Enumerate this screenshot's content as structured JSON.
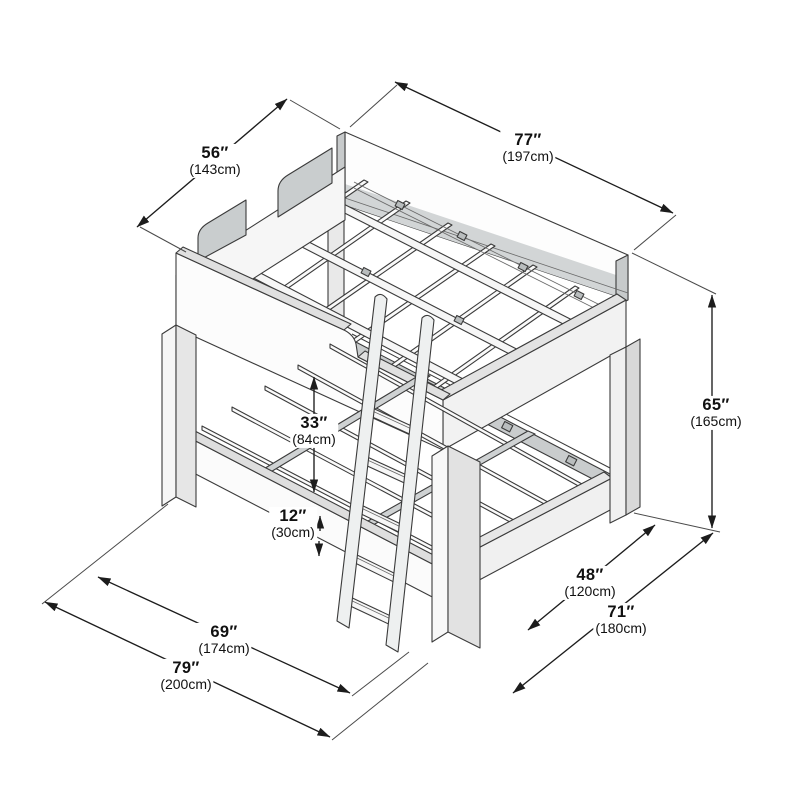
{
  "diagram": {
    "subject": "bunk bed with ladder",
    "style": "isometric technical line drawing with dimension callouts"
  },
  "dims": {
    "d56": {
      "inches": "56″",
      "cm": "(143cm)"
    },
    "d77": {
      "inches": "77″",
      "cm": "(197cm)"
    },
    "d65": {
      "inches": "65″",
      "cm": "(165cm)"
    },
    "d33": {
      "inches": "33″",
      "cm": "(84cm)"
    },
    "d12": {
      "inches": "12″",
      "cm": "(30cm)"
    },
    "d48": {
      "inches": "48″",
      "cm": "(120cm)"
    },
    "d71": {
      "inches": "71″",
      "cm": "(180cm)"
    },
    "d69": {
      "inches": "69″",
      "cm": "(174cm)"
    },
    "d79": {
      "inches": "79″",
      "cm": "(200cm)"
    }
  },
  "colors": {
    "line_color": "#3b3b3b",
    "dim_color": "#1c1c1c",
    "wit_color": "#4a4a4a",
    "label_color": "#111111",
    "background": "#ffffff"
  }
}
